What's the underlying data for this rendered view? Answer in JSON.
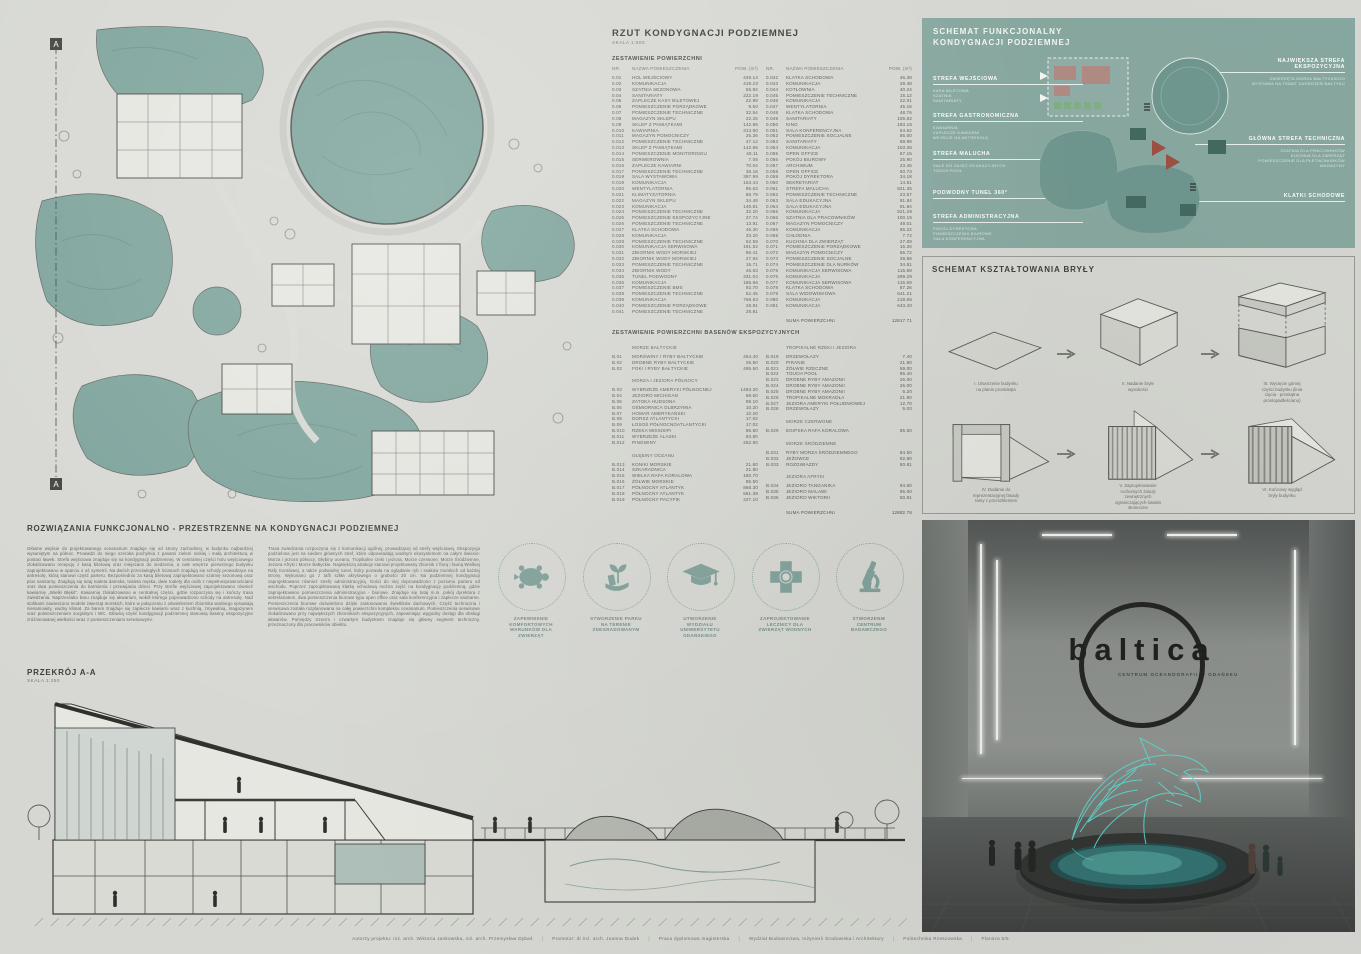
{
  "area_table": {
    "title": "RZUT KONDYGNACJI PODZIEMNEJ",
    "scale": "SKALA 1:500",
    "subtitle": "ZESTAWIENIE POWIERZCHNI",
    "header": {
      "nr": "NR.",
      "name": "NAZWA POMIESZCZENIA",
      "area": "POW. (m²)"
    },
    "left_rows": [
      {
        "nr": "0.01",
        "name": "HOL WEJŚCIOWY",
        "area": "449.14"
      },
      {
        "nr": "0.02",
        "name": "KOMUNIKACJA",
        "area": "419.23"
      },
      {
        "nr": "0.03",
        "name": "SZATNIA SEZONOWA",
        "area": "55.92"
      },
      {
        "nr": "0.04",
        "name": "SANITARIATY",
        "area": "222.19"
      },
      {
        "nr": "0.05",
        "name": "ZAPLECZE KASY BILETOWEJ",
        "area": "22.99"
      },
      {
        "nr": "0.06",
        "name": "POMIESZCZENIE PORZĄDKOWE",
        "area": "9.50"
      },
      {
        "nr": "0.07",
        "name": "POMIESZCZENIE TECHNICZNE",
        "area": "32.54"
      },
      {
        "nr": "0.08",
        "name": "MAGAZYN SKLEPU",
        "area": "22.25"
      },
      {
        "nr": "0.09",
        "name": "SKLEP Z PAMIĄTKAMI",
        "area": "142.86"
      },
      {
        "nr": "0.010",
        "name": "KAWIARNIA",
        "area": "313.90"
      },
      {
        "nr": "0.011",
        "name": "MAGAZYN POMOCNICZY",
        "area": "25.36"
      },
      {
        "nr": "0.012",
        "name": "POMIESZCZENIE TECHNICZNE",
        "area": "47.12"
      },
      {
        "nr": "0.013",
        "name": "SKLEP Z PAMIĄTKAMI",
        "area": "142.86"
      },
      {
        "nr": "0.014",
        "name": "POMIESZCZENIE MONITORINGU",
        "area": "40.11"
      },
      {
        "nr": "0.015",
        "name": "SERWEROWNIA",
        "area": "7.05"
      },
      {
        "nr": "0.016",
        "name": "ZAPLECZE KAWIARNI",
        "area": "70.04"
      },
      {
        "nr": "0.017",
        "name": "POMIESZCZENIE TECHNICZNE",
        "area": "38.18"
      },
      {
        "nr": "0.018",
        "name": "SALA WYSTAWOWA",
        "area": "397.99"
      },
      {
        "nr": "0.019",
        "name": "KOMUNIKACJA",
        "area": "153.44"
      },
      {
        "nr": "0.020",
        "name": "WENTYLATORNIA",
        "area": "85.63"
      },
      {
        "nr": "0.021",
        "name": "KLIMATYZATORNIA",
        "area": "88.79"
      },
      {
        "nr": "0.022",
        "name": "MAGAZYN SKLEPU",
        "area": "34.48"
      },
      {
        "nr": "0.023",
        "name": "KOMUNIKACJA",
        "area": "149.81"
      },
      {
        "nr": "0.024",
        "name": "POMIESZCZENIE TECHNICZNE",
        "area": "32.20"
      },
      {
        "nr": "0.025",
        "name": "POMIESZCZENIE EKSPOZYCYJNE",
        "area": "27.74"
      },
      {
        "nr": "0.026",
        "name": "POMIESZCZENIE TECHNICZNE",
        "area": "13.91"
      },
      {
        "nr": "0.027",
        "name": "KLATKA SCHODOWA",
        "area": "46.30"
      },
      {
        "nr": "0.028",
        "name": "KOMUNIKACJA",
        "area": "33.20"
      },
      {
        "nr": "0.029",
        "name": "POMIESZCZENIE TECHNICZNE",
        "area": "52.59"
      },
      {
        "nr": "0.030",
        "name": "KOMUNIKACJA SERWISOWA",
        "area": "191.52"
      },
      {
        "nr": "0.031",
        "name": "ZBIORNIK WODY MORSKIEJ",
        "area": "86.41"
      },
      {
        "nr": "0.032",
        "name": "ZBIORNIK WODY MORSKIEJ",
        "area": "27.94"
      },
      {
        "nr": "0.033",
        "name": "POMIESZCZENIE TECHNICZNE",
        "area": "15.71"
      },
      {
        "nr": "0.034",
        "name": "ZBIORNIK WODY",
        "area": "46.53"
      },
      {
        "nr": "0.035",
        "name": "TUNEL PODWODNY",
        "area": "331.04"
      },
      {
        "nr": "0.036",
        "name": "KOMUNIKACJA",
        "area": "185.96"
      },
      {
        "nr": "0.037",
        "name": "POMIESZCZENIE BMS",
        "area": "92.70"
      },
      {
        "nr": "0.038",
        "name": "POMIESZCZENIE TECHNICZNE",
        "area": "52.45"
      },
      {
        "nr": "0.039",
        "name": "KOMUNIKACJA",
        "area": "768.63"
      },
      {
        "nr": "0.040",
        "name": "POMIESZCZENIE PORZĄDKOWE",
        "area": "28.91"
      },
      {
        "nr": "0.041",
        "name": "POMIESZCZENIE TECHNICZNE",
        "area": "28.81"
      }
    ],
    "right_rows": [
      {
        "nr": "0.042",
        "name": "KLATKA SCHODOWA",
        "area": "46.38"
      },
      {
        "nr": "0.043",
        "name": "KOMUNIKACJA",
        "area": "28.48"
      },
      {
        "nr": "0.044",
        "name": "KOTŁOWNIA",
        "area": "40.24"
      },
      {
        "nr": "0.045",
        "name": "POMIESZCZENIE TECHNICZNE",
        "area": "15.12"
      },
      {
        "nr": "0.046",
        "name": "KOMUNIKACJA",
        "area": "22.01"
      },
      {
        "nr": "0.047",
        "name": "WENTYLATORNIA",
        "area": "45.16"
      },
      {
        "nr": "0.048",
        "name": "KLATKA SCHODOWA",
        "area": "48.76"
      },
      {
        "nr": "0.049",
        "name": "SANITARIATY",
        "area": "105.82"
      },
      {
        "nr": "0.050",
        "name": "KINO",
        "area": "193.15"
      },
      {
        "nr": "0.051",
        "name": "SALA KONFERENCYJNA",
        "area": "64.62"
      },
      {
        "nr": "0.052",
        "name": "POMIESZCZENIE SOCJALNE",
        "area": "56.00"
      },
      {
        "nr": "0.053",
        "name": "SANITARIATY",
        "area": "58.99"
      },
      {
        "nr": "0.054",
        "name": "KOMUNIKACJA",
        "area": "103.36"
      },
      {
        "nr": "0.055",
        "name": "OPEN OFFICE",
        "area": "67.15"
      },
      {
        "nr": "0.056",
        "name": "POKÓJ BIUROWY",
        "area": "25.90"
      },
      {
        "nr": "0.057",
        "name": "ARCHIWUM",
        "area": "23.45"
      },
      {
        "nr": "0.058",
        "name": "OPEN OFFICE",
        "area": "50.73"
      },
      {
        "nr": "0.059",
        "name": "POKÓJ DYREKTORA",
        "area": "34.18"
      },
      {
        "nr": "0.060",
        "name": "SEKRETARIAT",
        "area": "14.51"
      },
      {
        "nr": "0.061",
        "name": "STREFA MALUCHA",
        "area": "621.35"
      },
      {
        "nr": "0.062",
        "name": "POMIESZCZENIE TECHNICZNE",
        "area": "23.57"
      },
      {
        "nr": "0.063",
        "name": "SALA EDUKACYJNA",
        "area": "91.84"
      },
      {
        "nr": "0.064",
        "name": "SALA EDUKACYJNA",
        "area": "91.84"
      },
      {
        "nr": "0.065",
        "name": "KOMUNIKACJA",
        "area": "521.29"
      },
      {
        "nr": "0.066",
        "name": "SZATNIA DLA PRACOWNIKÓW",
        "area": "100.15"
      },
      {
        "nr": "0.067",
        "name": "MAGAZYN POMOCNICZY",
        "area": "49.01"
      },
      {
        "nr": "0.068",
        "name": "KOMUNIKACJA",
        "area": "55.22"
      },
      {
        "nr": "0.069",
        "name": "CHŁODNIA",
        "area": "7.72"
      },
      {
        "nr": "0.070",
        "name": "KUCHNIA DLA ZWIERZĄT",
        "area": "27.08"
      },
      {
        "nr": "0.071",
        "name": "POMIESZCZENIE PORZĄDKOWE",
        "area": "16.26"
      },
      {
        "nr": "0.072",
        "name": "MAGAZYN POMOCNICZY",
        "area": "65.72"
      },
      {
        "nr": "0.073",
        "name": "POMIESZCZENIE SOCJALNE",
        "area": "29.88"
      },
      {
        "nr": "0.074",
        "name": "POMIESZCZENIE DLA NURKÓW",
        "area": "34.81"
      },
      {
        "nr": "0.075",
        "name": "KOMUNIKACJA SERWISOWA",
        "area": "115.69"
      },
      {
        "nr": "0.076",
        "name": "KOMUNIKACJA",
        "area": "299.29"
      },
      {
        "nr": "0.077",
        "name": "KOMUNIKACJA SERWISOWA",
        "area": "115.69"
      },
      {
        "nr": "0.078",
        "name": "KLATKA SCHODOWA",
        "area": "87.26"
      },
      {
        "nr": "0.079",
        "name": "SALA WIDOWISKOWA",
        "area": "641.21"
      },
      {
        "nr": "0.080",
        "name": "KOMUNIKACJA",
        "area": "218.65"
      },
      {
        "nr": "0.081",
        "name": "KOMUNIKACJA",
        "area": "643.40"
      },
      {
        "nr": "",
        "name": "SUMA POWIERZCHNI",
        "area": "12817.71",
        "cls": "suma"
      }
    ]
  },
  "pools_table": {
    "title": "ZESTAWIENIE POWIERZCHNI BASENÓW EKSPOZYCYJNYCH",
    "left_rows": [
      {
        "nr": "",
        "name": "MORZE BAŁTYCKIE",
        "area": "",
        "cls": "ghead"
      },
      {
        "nr": "B.01",
        "name": "MORŚWINY I RYBY BAŁTYCKIE",
        "area": "464.40"
      },
      {
        "nr": "B.02",
        "name": "DROBNE RYBY BAŁTYCKIE",
        "area": "25.50"
      },
      {
        "nr": "B.03",
        "name": "FOKI I RYBY BAŁTYCKIE",
        "area": "495.50"
      },
      {
        "nr": "",
        "name": "MORZA I JEZIORA PÓŁNOCY",
        "area": "",
        "cls": "ghead"
      },
      {
        "nr": "B.03",
        "name": "WYBRZEŻE AMERYKI PÓŁNOCNEJ",
        "area": "1483.20"
      },
      {
        "nr": "B.04",
        "name": "JEZIORO MICHIGAN",
        "area": "69.50"
      },
      {
        "nr": "B.05",
        "name": "ZATOKA HUDSONA",
        "area": "99.10"
      },
      {
        "nr": "B.06",
        "name": "OŚMIORNICA OLBRZYMIA",
        "area": "10.20"
      },
      {
        "nr": "B.07",
        "name": "HOMAR AMERYKAŃSKI",
        "area": "10.20"
      },
      {
        "nr": "B.08",
        "name": "DORSZ ATLANTYCKI",
        "area": "17.02"
      },
      {
        "nr": "B.09",
        "name": "ŁOSOŚ PÓŁNOCNOATLANTYCKI",
        "area": "17.02"
      },
      {
        "nr": "B.010",
        "name": "RZEKA MISSISIPI",
        "area": "86.50"
      },
      {
        "nr": "B.011",
        "name": "WYBRZEŻE ALASKI",
        "area": "93.80"
      },
      {
        "nr": "B.012",
        "name": "PINGWINY",
        "area": "252.90"
      },
      {
        "nr": "",
        "name": "GŁĘBINY OCEANU",
        "area": "",
        "cls": "ghead"
      },
      {
        "nr": "B.013",
        "name": "KONIKI MORSKIE",
        "area": "21.80"
      },
      {
        "nr": "B.014",
        "name": "SZKARADNICA",
        "area": "21.80"
      },
      {
        "nr": "B.015",
        "name": "WIELKA RAFA KORALOWA",
        "area": "150.70"
      },
      {
        "nr": "B.016",
        "name": "ŻÓŁWIE MORSKIE",
        "area": "85.50"
      },
      {
        "nr": "B.017",
        "name": "PÓŁNOCNY ATLANTYK",
        "area": "868.30"
      },
      {
        "nr": "B.018",
        "name": "PÓŁNOCNY ATLANTYK",
        "area": "591.38"
      },
      {
        "nr": "B.019",
        "name": "PÓŁNOCNY PACYFIK",
        "area": "227.10"
      }
    ],
    "right_rows": [
      {
        "nr": "",
        "name": "TROPIKALNE RZEKI I JEZIORA",
        "area": "",
        "cls": "ghead"
      },
      {
        "nr": "B.019",
        "name": "DRZEWOŁAZY",
        "area": "7.40"
      },
      {
        "nr": "B.020",
        "name": "PIRANIE",
        "area": "21.80"
      },
      {
        "nr": "B.021",
        "name": "ŻÓŁWIE RZECZNE",
        "area": "59.00"
      },
      {
        "nr": "B.022",
        "name": "TOUCH POOL",
        "area": "95.40"
      },
      {
        "nr": "B.023",
        "name": "DROBNE RYBY AMAZONII",
        "area": "26.00"
      },
      {
        "nr": "B.024",
        "name": "DROBNE RYBY AMAZONII",
        "area": "26.00"
      },
      {
        "nr": "B.025",
        "name": "DROBNE RYBY AMAZONII",
        "area": "5.20"
      },
      {
        "nr": "B.026",
        "name": "TROPIKALNE MOKRADŁA",
        "area": "21.90"
      },
      {
        "nr": "B.027",
        "name": "JEZIORA AMERYKI POŁUDNIOWEJ",
        "area": "12.70"
      },
      {
        "nr": "B.028",
        "name": "DRZEWOŁAZY",
        "area": "5.00"
      },
      {
        "nr": "",
        "name": "MORZE CZERWONE",
        "area": "",
        "cls": "ghead"
      },
      {
        "nr": "B.029",
        "name": "EGIPSKA RAFA KORALOWA",
        "area": "85.50"
      },
      {
        "nr": "",
        "name": "MORZE ŚRÓDZIEMNE",
        "area": "",
        "cls": "ghead"
      },
      {
        "nr": "B.031",
        "name": "RYBY MORZA ŚRÓDZIEMNEGO",
        "area": "84.50"
      },
      {
        "nr": "B.032",
        "name": "JEŻOWCE",
        "area": "92.80"
      },
      {
        "nr": "B.033",
        "name": "ROZGWIAZDY",
        "area": "50.81"
      },
      {
        "nr": "",
        "name": "JEZIORA AFRYKI",
        "area": "",
        "cls": "ghead"
      },
      {
        "nr": "B.034",
        "name": "JEZIORO TANGANIKA",
        "area": "94.60"
      },
      {
        "nr": "B.035",
        "name": "JEZIORO MALAWI",
        "area": "95.00"
      },
      {
        "nr": "B.036",
        "name": "JEZIORO WIKTORII",
        "area": "50.81"
      },
      {
        "nr": "",
        "name": "SUMA POWIERZCHNI",
        "area": "12882.76",
        "cls": "suma"
      }
    ]
  },
  "functional": {
    "title": "SCHEMAT FUNKCJONALNY\nKONDYGNACJI PODZIEMNEJ",
    "left_zones": [
      {
        "name": "STREFA WEJŚCIOWA",
        "items": "KASA BILETOWA\nSZATNIA\nSANITARIATY"
      },
      {
        "name": "STREFA GASTRONOMICZNA",
        "items": "KAWIARNIA\nZAPLECZE KAWIARNI\nWEJŚCIE NA ANTRESOLĘ"
      },
      {
        "name": "STREFA MALUCHA",
        "items": "SALE DO ZAJĘĆ EDUKACYJNYCH\nTOUCH POOL"
      },
      {
        "name": "PODWODNY TUNEL 360°",
        "items": ""
      },
      {
        "name": "STREFA ADMINISTRACYJNA",
        "items": "POKÓJ DYREKTORA\nPOMIESZCZENIA BIUROWE\nSALA KONFERENCYJNA"
      }
    ],
    "right_zones": [
      {
        "name": "NAJWIĘKSZA STREFA\nEKSPOZYCYJNA",
        "items": "ZWIERZĘTA MORZA BAŁTYCKIEGO\nWYSTAWA NA TEMAT ZAGROŻEŃ BAŁTYKU"
      },
      {
        "name": "GŁÓWNA STREFA TECHNICZNA",
        "items": "SZATNIA DLA PRACOWNIKÓW\nKUCHNIA DLA ZWIERZĄT\nPOMIESZCZENIE DLA PŁETWONURKÓW\nMAGAZYNY"
      },
      {
        "name": "KLATKI SCHODOWE",
        "items": ""
      }
    ]
  },
  "massing": {
    "title": "SCHEMAT KSZTAŁTOWANIA BRYŁY",
    "steps": [
      {
        "caption": "I. Utworzenie budynku\nna planie prostokąta"
      },
      {
        "caption": "II. Nadanie bryle\nwysokości"
      },
      {
        "caption": "III. Wycięcie górnej\nczęści budynku (linia\ncięcia - przekątna\nprostopadłościanu)"
      },
      {
        "caption": "IV. Dodanie do\nreprezentacyjnej fasady\nramy z przeszkleniem"
      },
      {
        "caption": "V. Zaprojektowanie\nruchomych żaluzji\nzewnętrznych\nograniczających światło\nsłoneczne"
      },
      {
        "caption": "VI. Końcowy wygląd\nbryły budynku"
      }
    ]
  },
  "solutions": {
    "heading": "ROZWIĄZANIA FUNKCJONALNO - PRZESTRZENNE NA KONDYGNACJI PODZIEMNEJ",
    "col1": "Główne wejście do projektowanego oceanarium znajduje się od strony zachodniej, w budynku najbardziej wysuniętym na północ. Prowadzi do niego szeroka pochylnia z pasami zieleni niskiej i małą architekturą w postaci ławek. Strefa wejściowa znajduje się na kondygnacji podziemnej. W centralnej części holu wejściowego zlokalizowano recepcję z kasą biletową oraz miejscami do siedzenia, a całe wnętrze pierwszego budynku zaprojektowano w oparciu o oś symetrii. Na dwóch przeciwległych ścianach znajdują się schody prowadzące na antresolę, którą stanowi część parteru. Bezpośrednio za kasą biletową zaprojektowano szatnię sezonową oraz pion sanitarny. Znajdują się tutaj toaleta damska, toaleta męska, dwie toalety dla osób z niepełnosprawnościami oraz dwa pomieszczenia do karmienia i przewijania dzieci. Przy strefie wejściowej zaprojektowano również kawiarnię „Wielki Błękit”. Kawiarnię zlokalizowano w centralnej części, gdzie rozpoczyna się i kończy trasa zwiedzania. Naprzeciwko baru znajduje się akwarium, wokół którego poprowadzono schody na antresolę. Nad stolikami zawieszono modele zwierząt morskich, które w połączeniu z oświetleniem zbiornika wodnego sprawiają niesamowity, wodny klimat. Za barem znajduje się zaplecze kawiarni wraz z kuchnią, zmywalnią, magazynem oraz pomieszczeniem socjalnym i WC. Główną część kondygnacji podziemnej stanowią baseny ekspozycyjne zróżnicowanej wielkości wraz z pomieszczeniami serwisowymi.",
    "col2": "Trasa zwiedzania rozpoczyna się z komunikacji ogólnej, prowadzącej od strefy wejściowej. Ekspozycja podzielona jest na siedem głównych stref, które odpowiadają wodnym ekosystemom na całym świecie: Morza i jeziora północy, Głębiny oceanu, Tropikalne rzeki i jeziora, Morze czerwone, Morze Śródziemne, Jeziora Afryki i Morze Bałtyckie. Największą atrakcję stanowi projektowany zbiornik z florą i fauną Wielkiej Rafy Koralowej, a także podwodny tunel, który pozwala na oglądanie ryb i ssaków morskich od każdej strony. Wykonano go z tafli szkła akrylowego o grubości 20 cm. Na podziemnej kondygnacji zaprojektowano również strefę administracyjną. Gości do niej doprowadzono z poziomu parteru od wschodu. Poprzez zaprojektowaną klatkę schodową można zejść na kondygnację podziemną, gdzie zaprojektowano pomieszczenia administracyjno - biurowe. Znajduje się tutaj m.in. pokój dyrektora z sekretariatem, dwa pomieszczenia biurowe typu open office oraz sala konferencyjna i zaplecze sanitarne. Pomieszczenia biurowe doświetlono dzięki zastosowaniu świetlików dachowych. Część techniczna i serwisowa została rozplanowana na całej powierzchni kompleksu oceanarium. Pomieszczenia serwisowe zlokalizowano przy największych zbiornikach ekspozycyjnych, zapewniając wygodny dostęp dla obsługi akwariów. Pomiędzy trzecim i czwartym budynkiem znajduje się główny segment techniczny, przeznaczony dla pracowników obiektu."
  },
  "goals": {
    "items": [
      {
        "caption": "ZAPEWNIENIE\nKOMFORTOWYCH\nWARUNKÓW DLA\nZWIERZĄT"
      },
      {
        "caption": "STWORZENIE PARKU\nNA TERENIE\nZDEGRADOWANYM"
      },
      {
        "caption": "UTWORZENIE\nWYDZIAŁU\nUNIWERSYTETU\nGDAŃSKIEGO"
      },
      {
        "caption": "ZAPROJEKTOWANIE\nLECZNICY DLA\nZWIERZĄT WODNYCH"
      },
      {
        "caption": "STWORZENIE\nCENTRUM\nBADAWCZEGO"
      }
    ]
  },
  "section_drawing": {
    "title": "PRZEKRÓJ A-A",
    "scale": "SKALA 1:250",
    "marker": "A"
  },
  "render": {
    "logo": "baltica",
    "subtitle": "CENTRUM OCEANOGRAFII W GDAŃSKU"
  },
  "footer": {
    "items": [
      {
        "t": "Autorzy projektu: inż. arch. Wiktoria Jankowska, inż. arch. Przemysław Dybaś"
      },
      {
        "t": "Promotor: dr inż. arch. Joanna Dudek"
      },
      {
        "t": "Praca dyplomowa magisterska"
      },
      {
        "t": "Wydział Budownictwa, Inżynierii Środowiska i Architektury"
      },
      {
        "t": "Politechnika Rzeszowska"
      },
      {
        "t": "Plansza 5/5"
      }
    ]
  }
}
